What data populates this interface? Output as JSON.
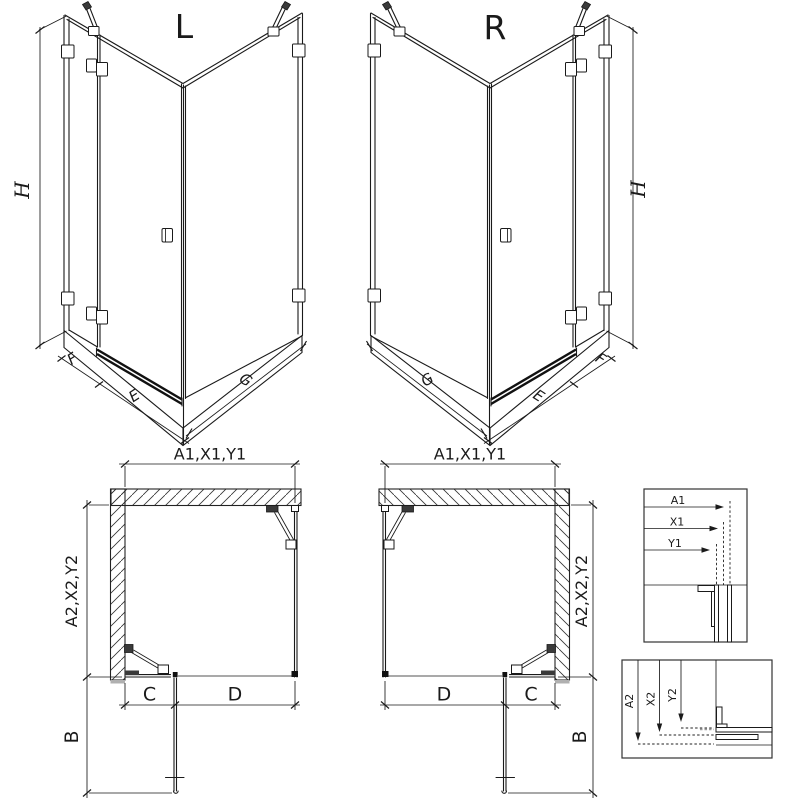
{
  "drawing": {
    "views": {
      "l3d": {
        "title": "L",
        "height": "H",
        "fixed_panel": "F",
        "door_panel": "E",
        "side_panel": "G"
      },
      "r3d": {
        "title": "R",
        "height": "H",
        "fixed_panel": "F",
        "door_panel": "E",
        "side_panel": "G"
      },
      "plan_l": {
        "width_dim": "A1,X1,Y1",
        "depth_dim": "A2,X2,Y2",
        "door_swing": "B",
        "c_dim": "C",
        "d_dim": "D"
      },
      "plan_r": {
        "width_dim": "A1,X1,Y1",
        "depth_dim": "A2,X2,Y2",
        "door_swing": "B",
        "c_dim": "C",
        "d_dim": "D"
      },
      "detail_width": {
        "a1": "A1",
        "x1": "X1",
        "y1": "Y1"
      },
      "detail_depth": {
        "a2": "A2",
        "x2": "X2",
        "y2": "Y2"
      }
    },
    "colors": {
      "line": "#1a1a1a",
      "gray": "#b0b0b0",
      "background": "#ffffff"
    }
  }
}
